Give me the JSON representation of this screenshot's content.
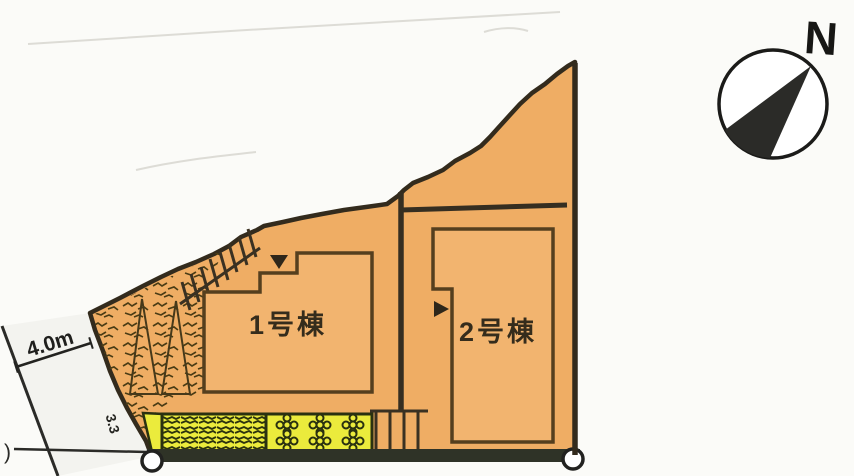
{
  "site_plan": {
    "buildings": [
      {
        "label": "1号棟"
      },
      {
        "label": "2号棟"
      }
    ],
    "road": {
      "width_label": "4.0m",
      "boundary_dimension_label": "3.3",
      "truncated_label": ")"
    },
    "compass": {
      "north_label": "N"
    },
    "colors": {
      "lot_fill": "#efad64",
      "building_fill": "#f2b46f",
      "lot_outline": "#332b1d",
      "building_outline": "#553f1e",
      "planting_yellow": "#ebeb3c",
      "hatch_dark": "#333b12",
      "road_band_dark": "#2f3327",
      "label_text": "#352c1c"
    }
  }
}
